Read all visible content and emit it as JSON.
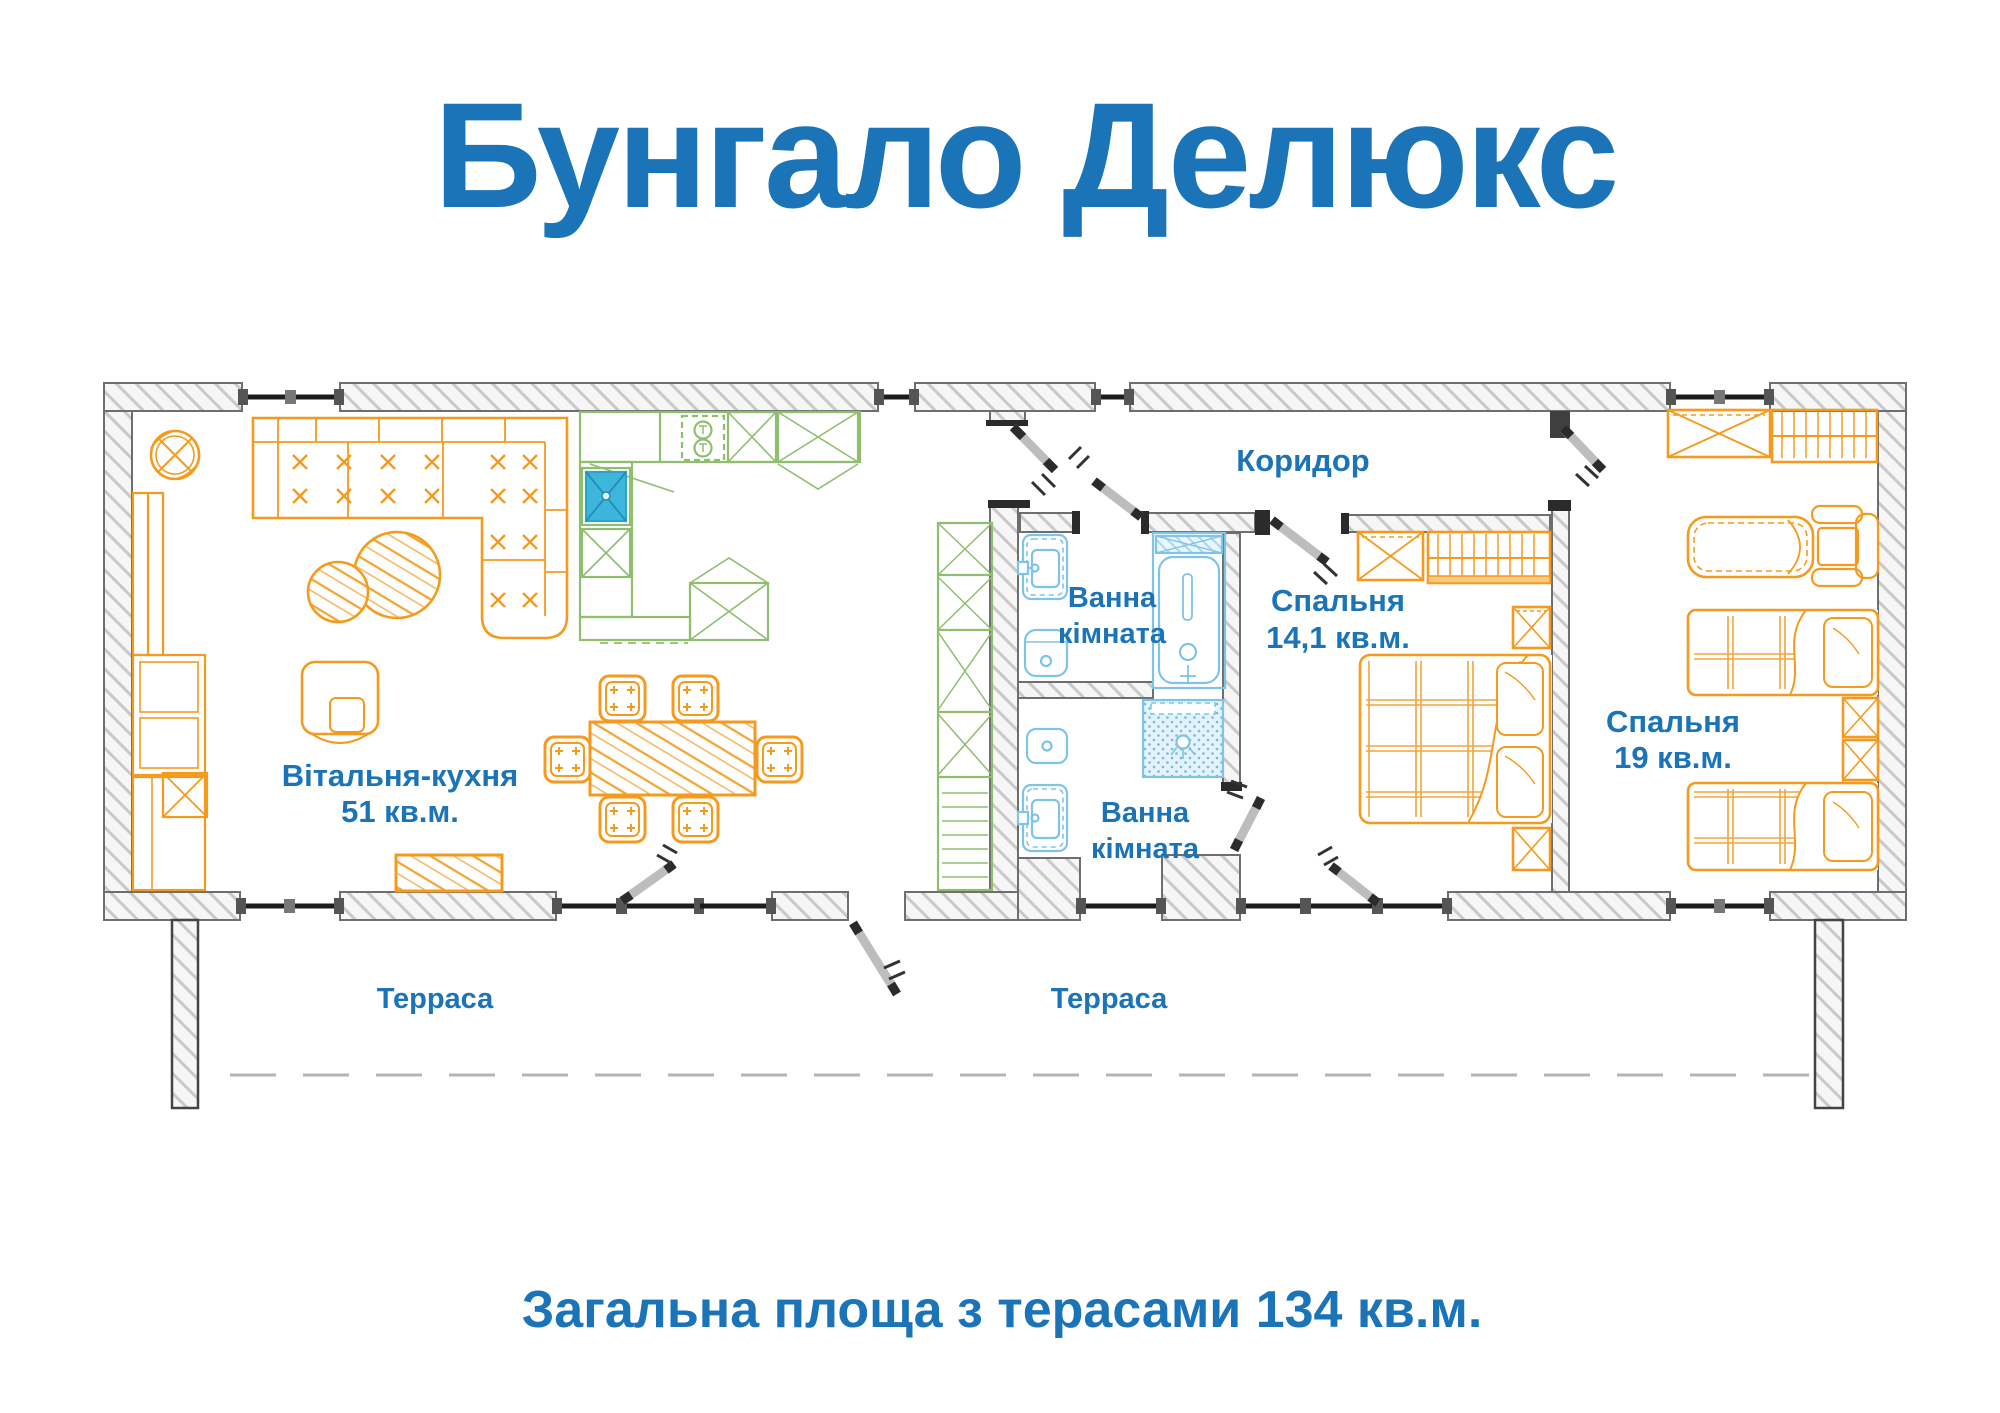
{
  "title": "Бунгало Делюкс",
  "subtitle": "Загальна площа з терасами 134 кв.м.",
  "rooms": {
    "living_kitchen": {
      "name": "Вітальня-кухня",
      "area": "51 кв.м."
    },
    "bathroom_top": {
      "line1": "Ванна",
      "line2": "кімната"
    },
    "bathroom_bottom": {
      "line1": "Ванна",
      "line2": "кімната"
    },
    "corridor": {
      "name": "Коридор"
    },
    "bedroom_main": {
      "name": "Спальня",
      "area": "14,1 кв.м."
    },
    "bedroom_second": {
      "name": "Спальня",
      "area": "19 кв.м."
    },
    "terrace_left": {
      "name": "Терраса"
    },
    "terrace_right": {
      "name": "Терраса"
    }
  },
  "colors": {
    "accent_text": "#1B74B8",
    "furniture": "#F49B1F",
    "kitchen": "#8FBE6E",
    "plumbing": "#7FC3E8",
    "sink_fill": "#3EB6DC",
    "walls": "#6E6E6E"
  }
}
